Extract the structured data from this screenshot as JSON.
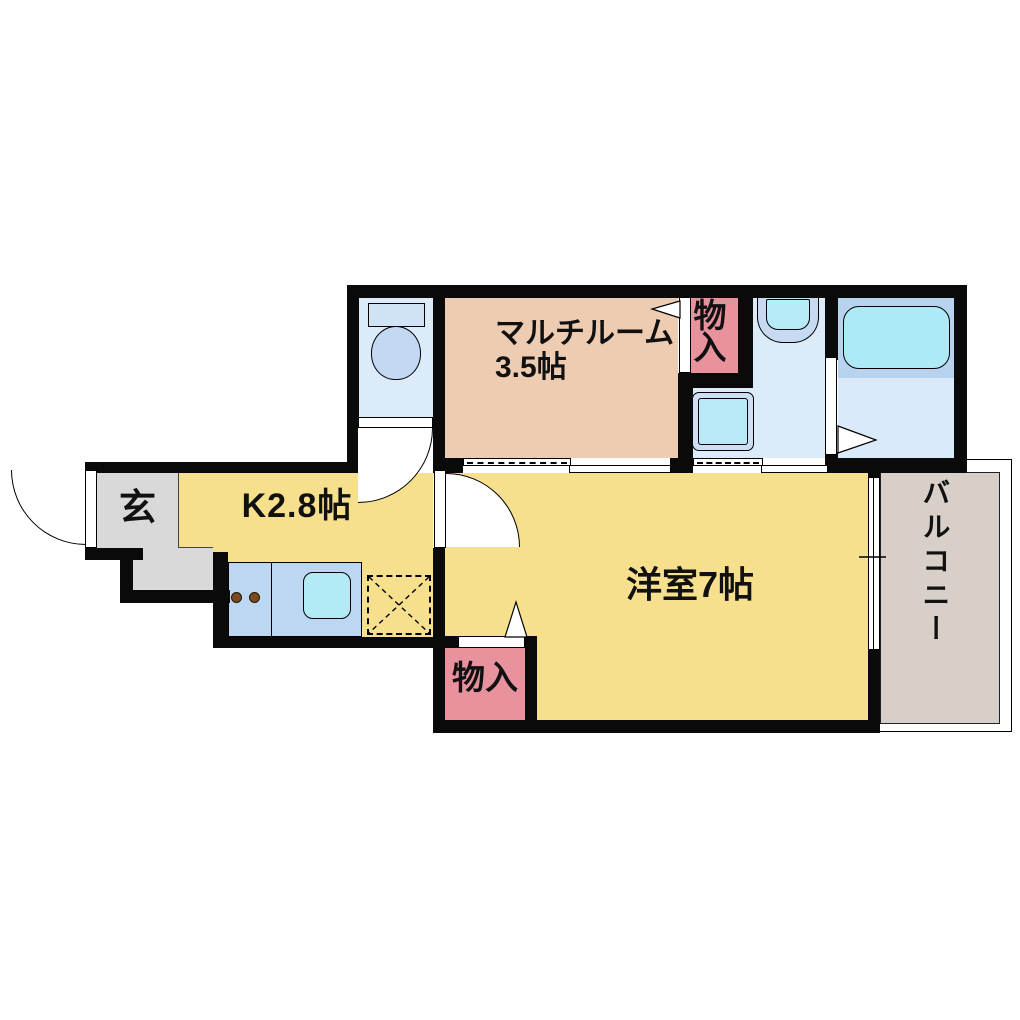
{
  "plan": {
    "type": "japanese-apartment-floor-plan",
    "rooms": {
      "entrance": {
        "label": "玄"
      },
      "kitchen": {
        "label": "K2.8帖"
      },
      "western_room": {
        "label": "洋室7帖"
      },
      "multi_room": {
        "name": "マルチルーム",
        "size": "3.5帖"
      },
      "storage_top": {
        "label": "物入"
      },
      "storage_bottom": {
        "label": "物入"
      },
      "balcony": {
        "label": "バルコニー"
      }
    },
    "fixtures": {
      "toilet": "toilet",
      "bathtub": "bathtub",
      "washbasin": "washbasin",
      "washing_machine_pan": "washing-machine-pan",
      "kitchen_counter": "kitchen-counter-with-sink",
      "stove_burners": "two-burner-stove",
      "refrigerator_space": "refrigerator-space-dashed-x"
    },
    "colors": {
      "wall": "#0a0a0a",
      "room_yellow": "#f7e08d",
      "multi_room_tan": "#eeccb2",
      "storage_pink": "#e8929e",
      "entrance_gray": "#d9d9d9",
      "balcony_gray": "#d8d0c8",
      "wet_area_floor": "#dcebfa",
      "bath_panel_blue": "#b7d3ef",
      "tub_cyan": "#aeeaf6",
      "counter_blue": "#bdd7f2",
      "sink_cyan": "#b2ebf6",
      "burner_brown": "#7b4a1f"
    }
  }
}
